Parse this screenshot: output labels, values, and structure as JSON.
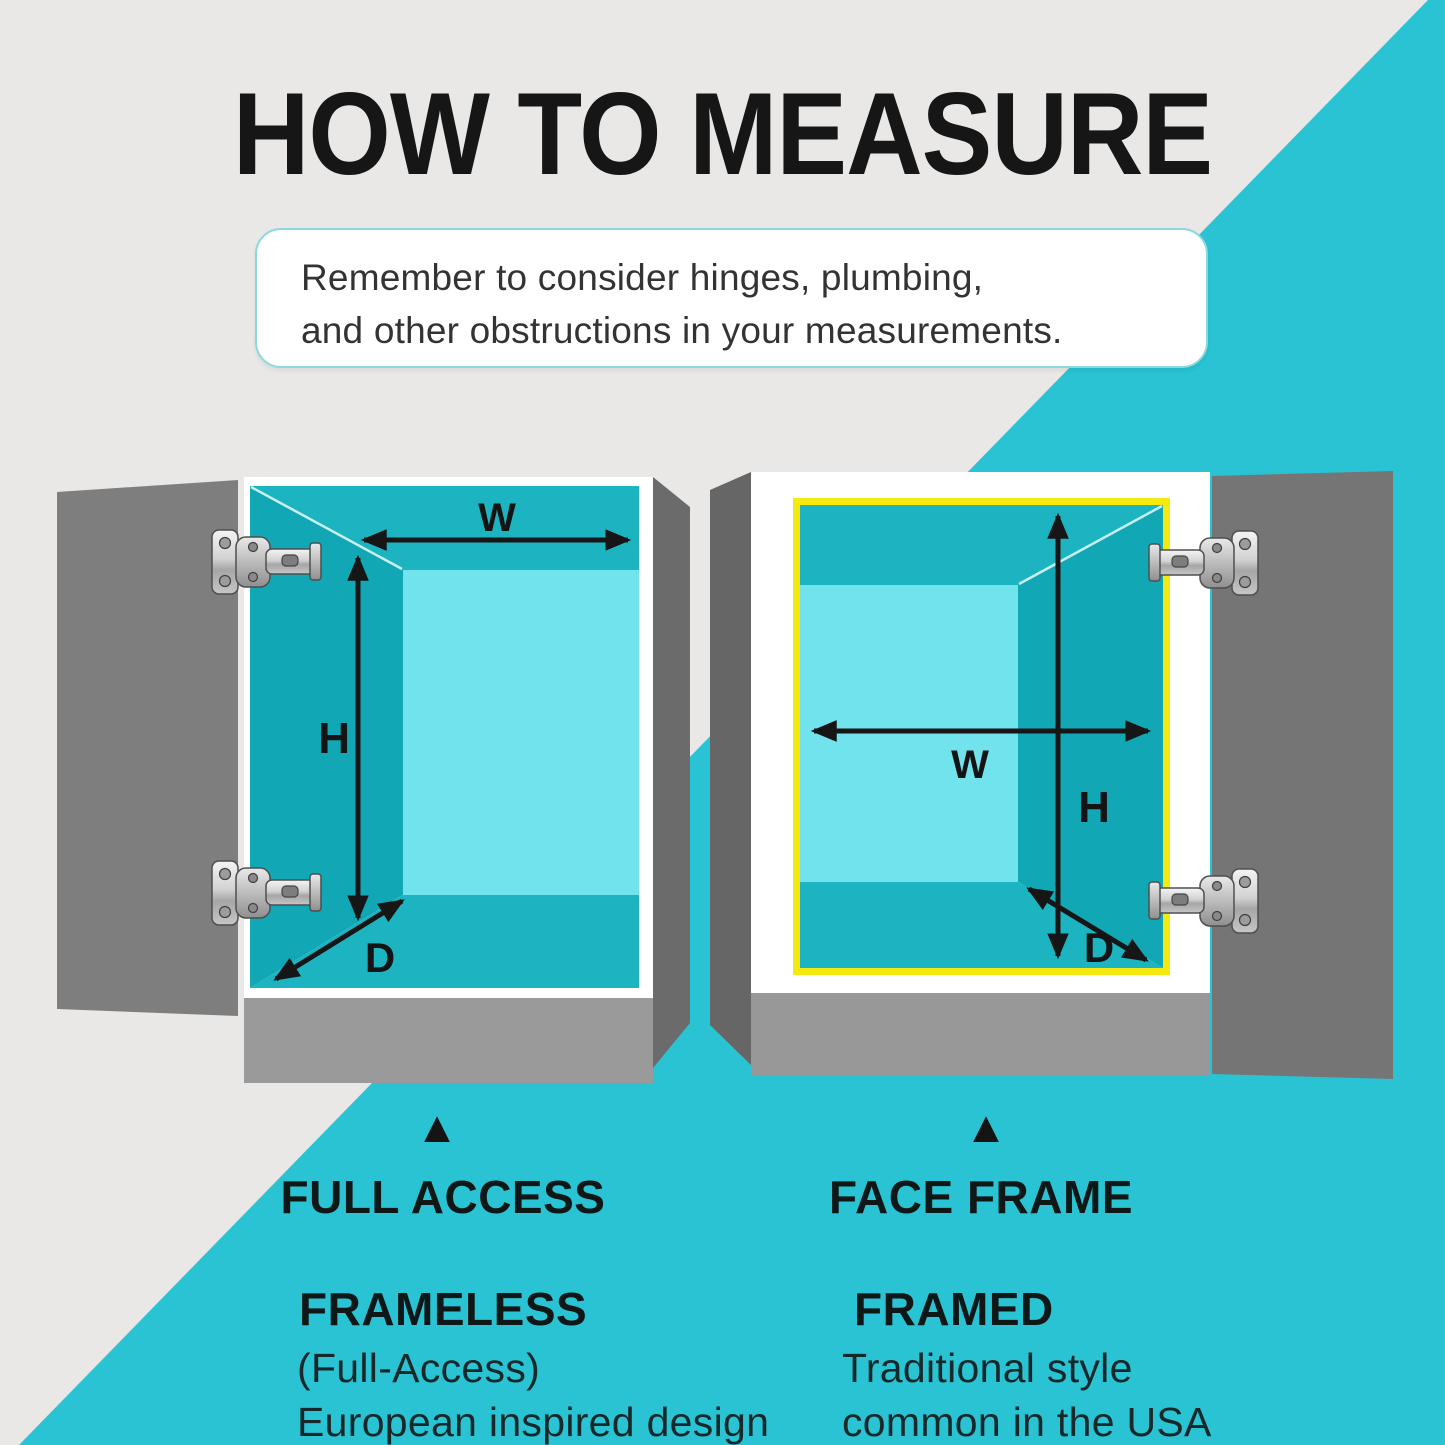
{
  "title": "HOW TO MEASURE",
  "note": {
    "line1": "Remember to consider hinges, plumbing,",
    "line2": "and other obstructions in your measurements."
  },
  "cabinets": {
    "left": {
      "marker": "▲",
      "heading": "FULL ACCESS",
      "style_name": "FRAMELESS",
      "description_line1": "(Full-Access)",
      "description_line2": "European inspired design",
      "dimensions": {
        "width_label": "W",
        "height_label": "H",
        "depth_label": "D"
      }
    },
    "right": {
      "marker": "▲",
      "heading": "FACE FRAME",
      "style_name": "FRAMED",
      "description_line1": "Traditional style",
      "description_line2": "common in the USA",
      "dimensions": {
        "width_label": "W",
        "height_label": "H",
        "depth_label": "D"
      }
    }
  },
  "colors": {
    "background_gray": "#e9e8e6",
    "background_teal": "#29c3d3",
    "frame_yellow": "#f5e90f",
    "interior_wall_teal": "#1db4c2",
    "interior_side_teal": "#11a7b5",
    "interior_back_cyan": "#70e3ed",
    "door_gray": "#7c7c7c",
    "base_gray": "#9a9a9a",
    "text_black": "#161616"
  }
}
